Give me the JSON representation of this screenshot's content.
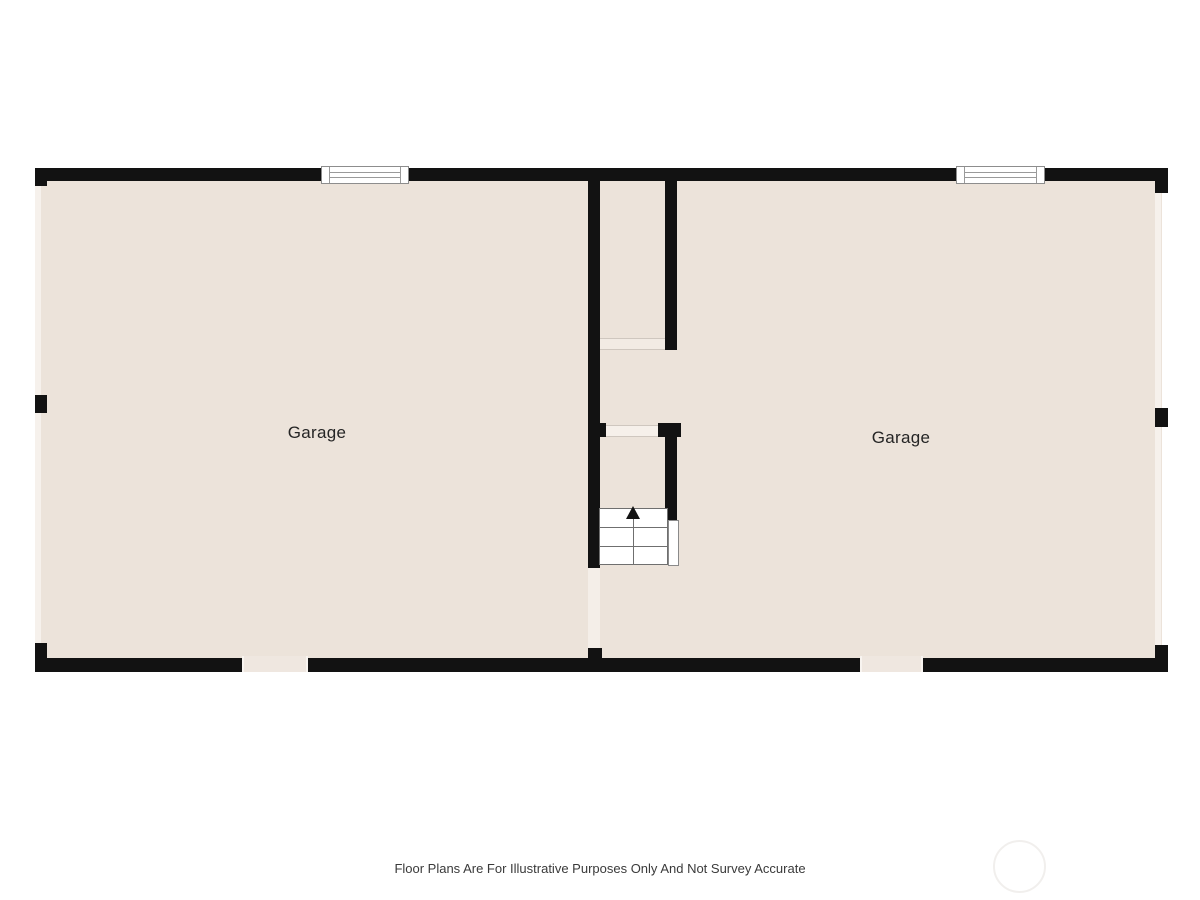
{
  "floorplan": {
    "rooms": [
      {
        "label": "Garage"
      },
      {
        "label": "Garage"
      }
    ],
    "stairs": {
      "direction": "up"
    },
    "colors": {
      "wall": "#121212",
      "floor": "#ece3da",
      "opening": "#f6f1ec",
      "line": "#6f6f6f"
    }
  },
  "footer": {
    "disclaimer": "Floor Plans Are For Illustrative Purposes Only And Not Survey Accurate"
  }
}
